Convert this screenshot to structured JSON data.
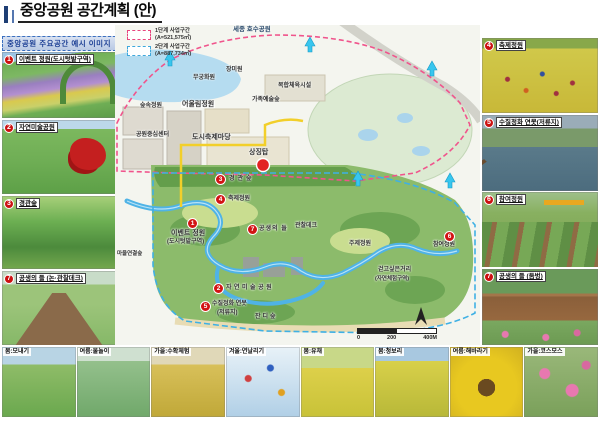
{
  "title": "중앙공원 공간계획 (안)",
  "sidebar_header": "중앙공원 주요공간 예시 이미지",
  "legend": {
    "phase1_label": "1단계 사업구간",
    "phase1_area": "(A=521,575㎡)",
    "phase2_label": "2단계 사업구간",
    "phase2_area": "(A=887,734㎡)"
  },
  "left_photos": [
    {
      "num": "1",
      "label": "이벤트 정원(도시텃밭구역)"
    },
    {
      "num": "2",
      "label": "자연미술공원"
    },
    {
      "num": "3",
      "label": "경관숲"
    },
    {
      "num": "7",
      "label": "공생의 들 (논·관찰데크)"
    }
  ],
  "right_photos": [
    {
      "num": "4",
      "label": "축제정원"
    },
    {
      "num": "5",
      "label": "수질정화 연못(저류지)"
    },
    {
      "num": "6",
      "label": "참여정원"
    },
    {
      "num": "7",
      "label": "공생의 들 (둠벙)"
    }
  ],
  "map": {
    "lake_label": "세종 호수공원",
    "labels": {
      "mugunghwa_garden": "무궁화원",
      "rose_garden": "장미원",
      "sports_complex": "복합체육시설",
      "family_art_forest": "가족예술숲",
      "forest_garden": "숲속정원",
      "harmony_garden": "어울림정원",
      "park_center": "공원중심센터",
      "city_festival_ground": "도시축제마당",
      "symbol_tower": "상징탑",
      "scenic_forest": "경관숲",
      "festival_garden": "축제정원",
      "event_garden": "이벤트 정원",
      "event_garden_zone": "(도시텃밭구역)",
      "symbiosis_field": "공생의 들",
      "observation_deck": "관찰데크",
      "theme_garden": "주제정원",
      "participation_garden": "참여정원",
      "walkable_street": "걷고싶은거리",
      "nature_zone": "(자연체험구역)",
      "nature_art_park": "자연미술공원",
      "purification_pond": "수질정화 연못",
      "retention_basin": "(저류지)",
      "lawn_forest": "잔디숲",
      "village_link_forest": "마을연결숲"
    },
    "markers": {
      "m1": "1",
      "m2": "2",
      "m3": "3",
      "m4": "4",
      "m5": "5",
      "m6": "6",
      "m7": "7"
    },
    "scale": {
      "s0": "0",
      "s200": "200",
      "s400": "400M"
    }
  },
  "bottom_photos": [
    {
      "caption": "봄:모내기"
    },
    {
      "caption": "여름:물놀이"
    },
    {
      "caption": "가을:수확체험"
    },
    {
      "caption": "겨울:연날리기"
    },
    {
      "caption": "봄:유채"
    },
    {
      "caption": "봄:청보리"
    },
    {
      "caption": "여름:해바라기"
    },
    {
      "caption": "가을:코스모스"
    }
  ],
  "colors": {
    "phase1": "#e8447e",
    "phase2": "#3fa8dc",
    "marker": "#d21414",
    "stream": "#4fb3e6",
    "path_yellow": "#f2cf2a"
  }
}
